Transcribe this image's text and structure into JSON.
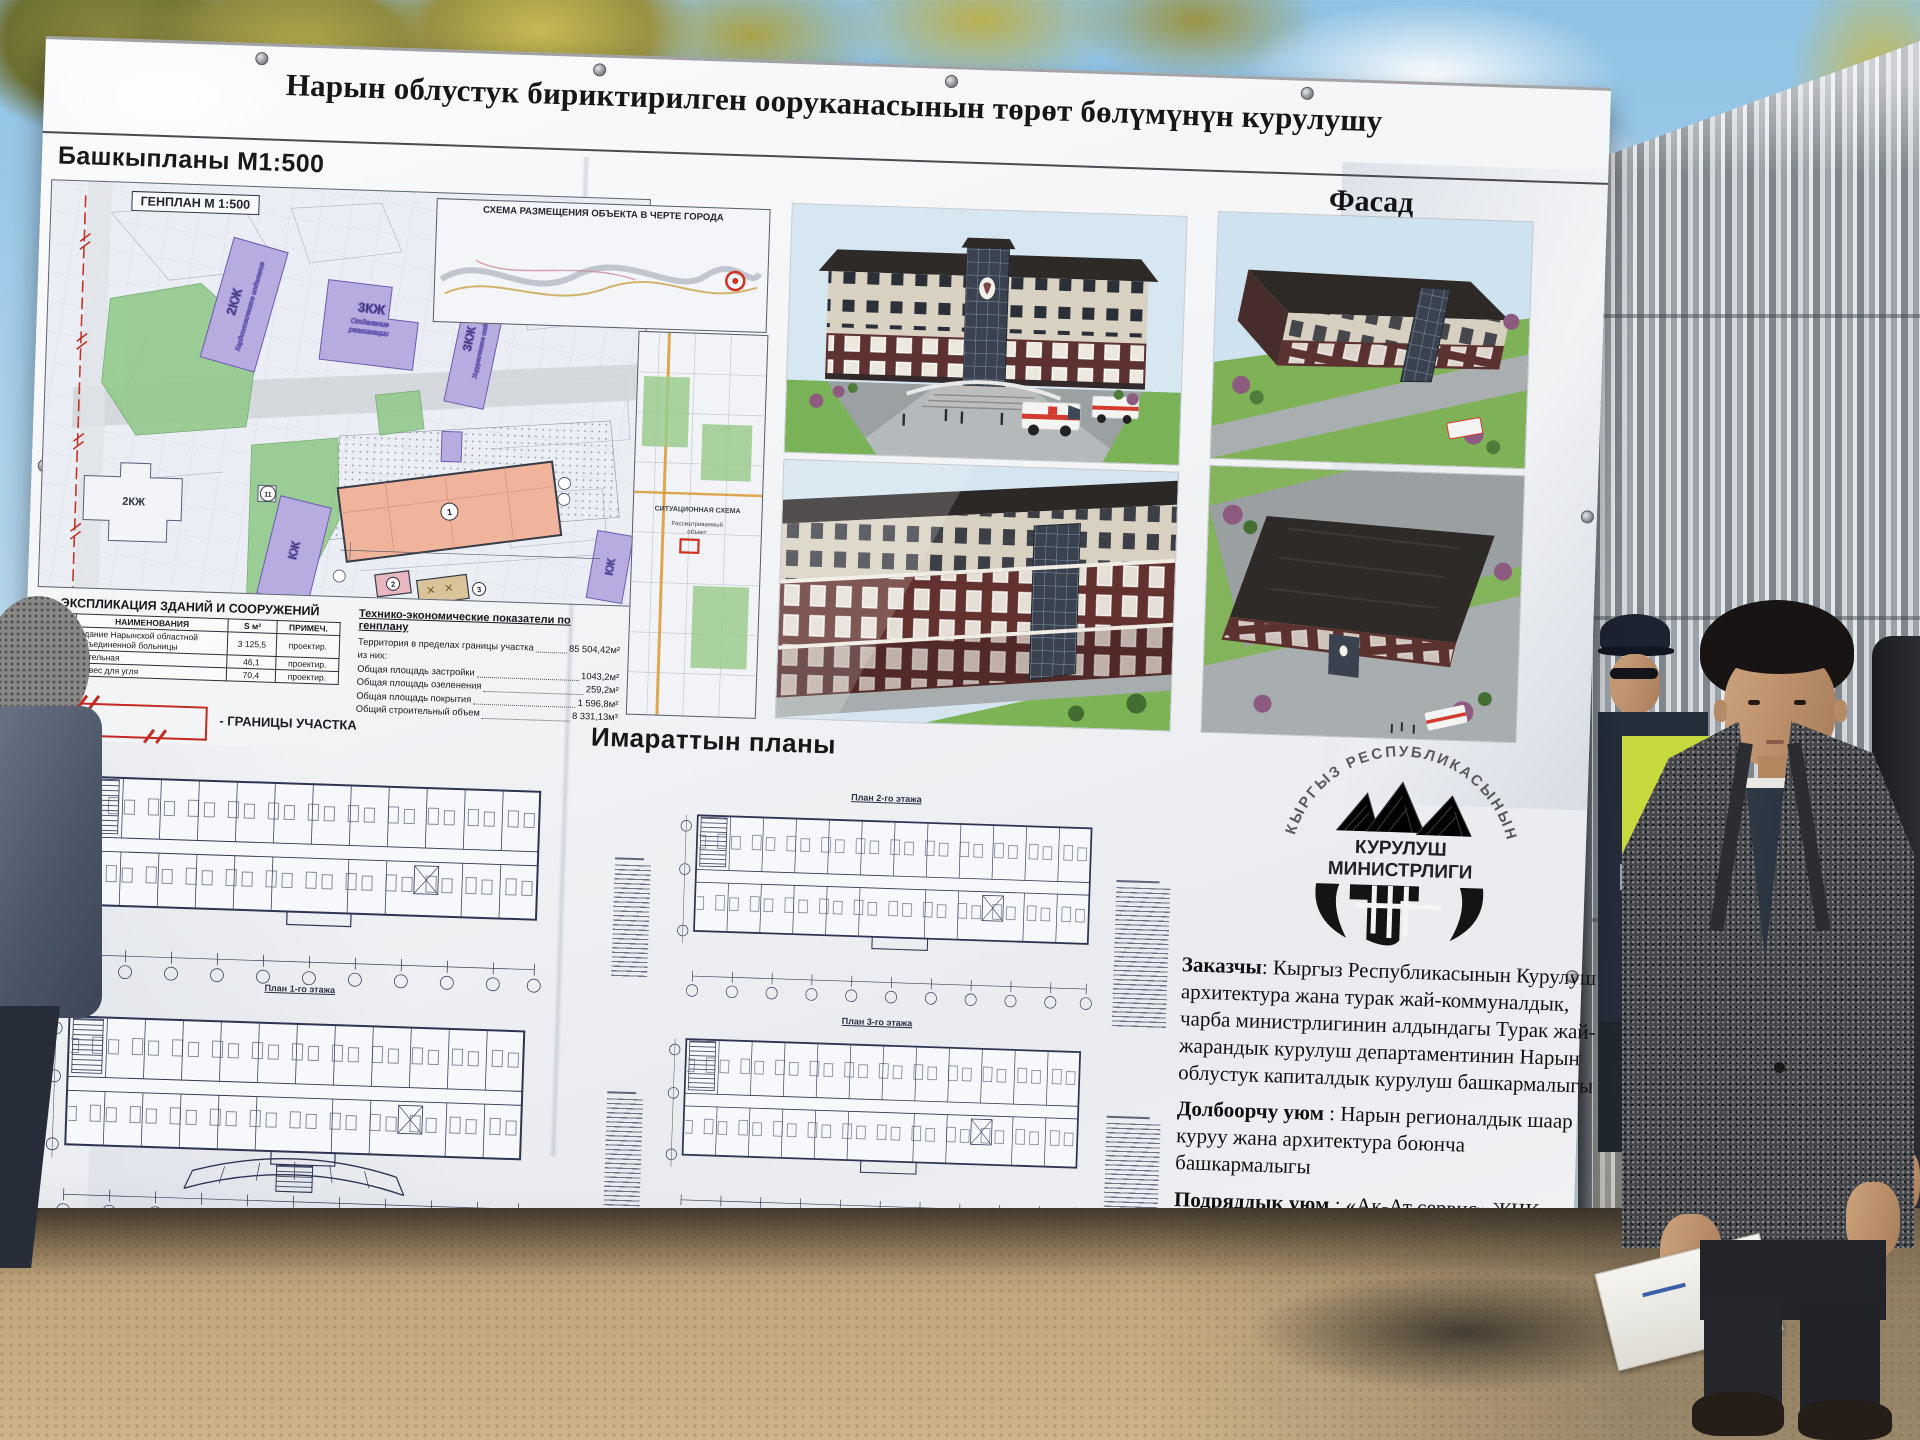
{
  "banner": {
    "title": "Нарын облустук бириктирилген ооруканасынын төрөт бөлүмүнүн курулушу",
    "genplan": {
      "heading": "Башкыпланы М1:500",
      "map_label": "ГЕНПЛАН М 1:500",
      "schema_title": "СХЕМА РАЗМЕЩЕНИЯ ОБЪЕКТА В ЧЕРТЕ ГОРОДА",
      "sit_title": "СИТУАЦИОННАЯ СХЕМА",
      "sit_object_line1": "Рассматриваемый",
      "sit_object_line2": "объект",
      "labels": {
        "cardio_floors": "2КЖ",
        "cardio_name": "Кардиологическое отделение",
        "rean_floors": "3КЖ",
        "rean_name1": "Отделение",
        "rean_name2": "реанимации",
        "surg_floors": "3КЖ",
        "surg_name": "Хирургическое отделение",
        "kzh_main": "КЖ",
        "kzh_right": "КЖ",
        "house": "2КЖ",
        "tp": "ТП"
      },
      "markers": {
        "main": "1",
        "boiler": "2",
        "shed": "3",
        "m11": "11"
      }
    },
    "explication": {
      "title": "ЭКСПЛИКАЦИЯ ЗДАНИЙ И СООРУЖЕНИЙ",
      "columns": [
        "№ П.П.",
        "НАИМЕНОВАНИЯ",
        "S м²",
        "ПРИМЕЧ."
      ],
      "rows": [
        [
          "1",
          "Здание Нарынской областной объединенной больницы",
          "3 125,5",
          "проектир."
        ],
        [
          "2",
          "Котельная",
          "46,1",
          "проектир."
        ],
        [
          "3",
          "Навес для угля",
          "70,4",
          "проектир."
        ]
      ],
      "boundary_legend": "- ГРАНИЦЫ УЧАСТКА"
    },
    "tep": {
      "title": "Технико-экономические показатели по генплану",
      "rows": [
        {
          "label": "Территория в пределах границы участка",
          "value": "85 504,42м²"
        },
        {
          "label": "из них:",
          "value": ""
        },
        {
          "label": "Общая площадь застройки",
          "value": "1043,2м²"
        },
        {
          "label": "Общая площадь озеленения",
          "value": "259,2м²"
        },
        {
          "label": "Общая площадь покрытия",
          "value": "1 596,8м²"
        },
        {
          "label": "Общий строительный объем",
          "value": "8 331,13м³"
        }
      ]
    },
    "facade_heading": "Фасад",
    "plans": {
      "heading": "Имараттын планы",
      "label_floor1": "План 1-го этажа",
      "label_floor2": "План 2-го этажа",
      "label_floor3": "План 3-го этажа"
    },
    "logo": {
      "arc": "КЫРГЫЗ РЕСПУБЛИКАСЫНЫН",
      "line1": "КУРУЛУШ",
      "line2": "МИНИСТРЛИГИ"
    },
    "info": {
      "rows": [
        {
          "label": "Заказчы",
          "sep": ": ",
          "value": "Кыргыз Республикасынын Курулуш архитектура жана турак жай-коммуналдык, чарба министрлигинин алдындагы Турак жай-жарандык курулуш департаментинин Нарын облустук капиталдык курулуш башкармалыгы"
        },
        {
          "label": "Долбоорчу уюм",
          "sep": " : ",
          "value": "Нарын регионалдык шаар куруу жана архитектура боюнча башкармалыгы"
        },
        {
          "label": "Подряддык уюм",
          "sep": " : ",
          "value": "«Ак-Ат сервис» ЖЧК"
        },
        {
          "label": "Сметалык баасы",
          "sep": ": ",
          "value": "269 766,600 миң сом"
        },
        {
          "label": "Курулуш башталган жылы",
          "sep": " : ",
          "value": "2025-жыл"
        },
        {
          "label": "Негизги имараттын аянты",
          "sep": " : ",
          "value": "3129,5 м²"
        }
      ]
    }
  }
}
